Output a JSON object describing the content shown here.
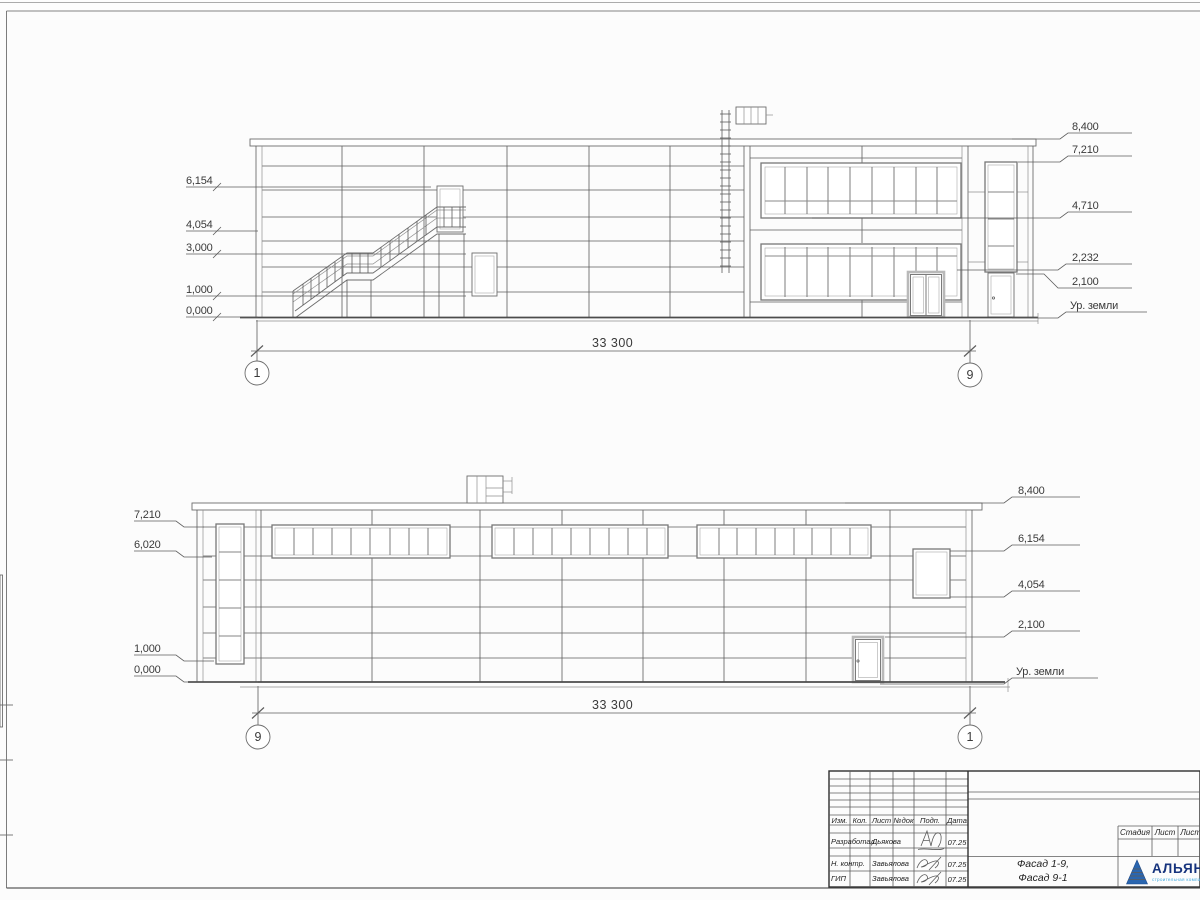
{
  "top_facade": {
    "axis_left": "1",
    "axis_right": "9",
    "dimension": "33 300",
    "marks_left": [
      "6,154",
      "4,054",
      "3,000",
      "1,000",
      "0,000"
    ],
    "marks_right": [
      "8,400",
      "7,210",
      "4,710",
      "2,232",
      "2,100",
      "Ур. земли"
    ]
  },
  "bottom_facade": {
    "axis_left": "9",
    "axis_right": "1",
    "dimension": "33 300",
    "marks_left": [
      "7,210",
      "6,020",
      "1,000",
      "0,000"
    ],
    "marks_right": [
      "8,400",
      "6,154",
      "4,054",
      "2,100",
      "Ур. земли"
    ]
  },
  "title_block": {
    "header_cols": [
      "Изм.",
      "Кол.",
      "Лист",
      "№док",
      "Подп.",
      "Дата"
    ],
    "rows": [
      {
        "role": "Разработал",
        "name": "Дьякова",
        "date": "07.25"
      },
      {
        "role": "Н. контр.",
        "name": "Завьялова",
        "date": "07.25"
      },
      {
        "role": "ГИП",
        "name": "Завьялова",
        "date": "07.25"
      }
    ],
    "stage_cols": [
      "Стадия",
      "Лист",
      "Листов"
    ],
    "title_line1": "Фасад 1-9,",
    "title_line2": "Фасад 9-1",
    "logo": {
      "name": "АЛЬЯНС",
      "subtitle": "строительная компания"
    },
    "colors": {
      "logo_text": "#16337d",
      "logo_triangle": "#2a66b0",
      "logo_subtitle": "#41a8dd"
    }
  }
}
